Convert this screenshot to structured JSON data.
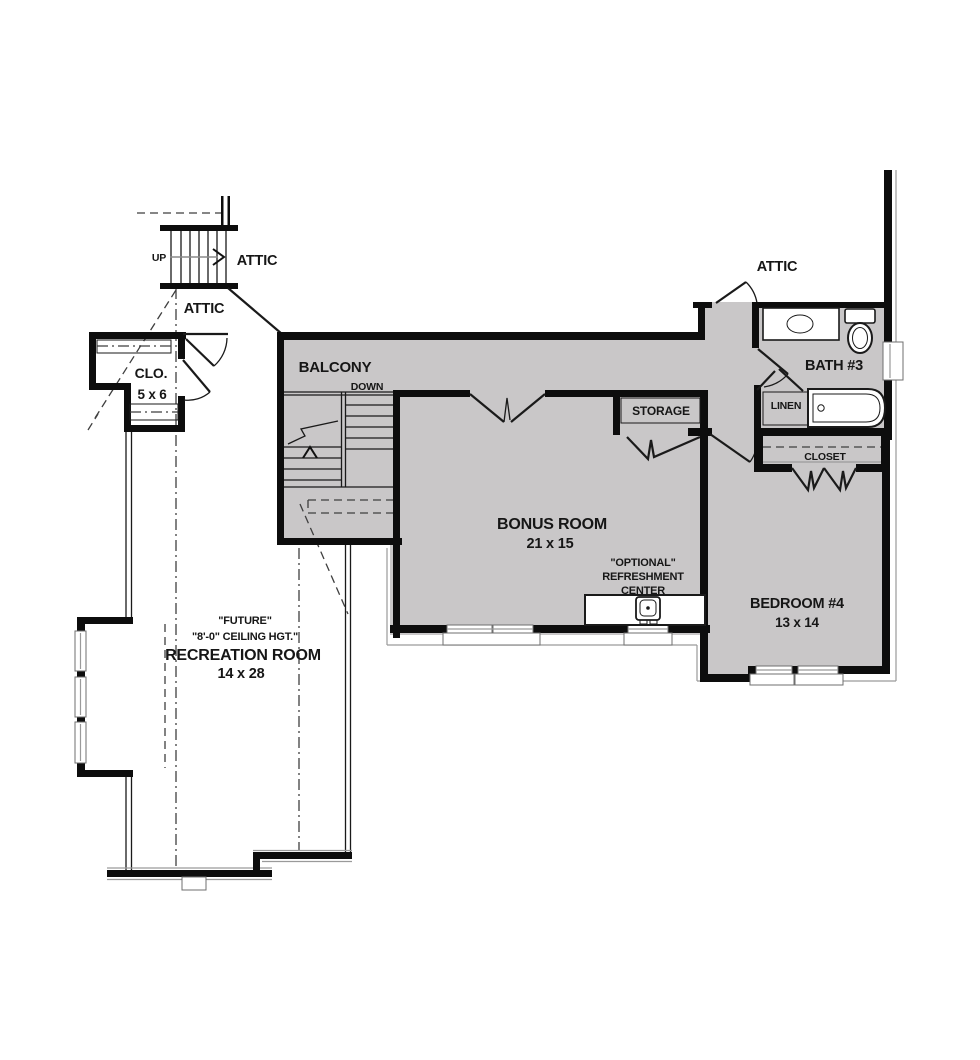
{
  "title": "Second Floor Plan",
  "colors": {
    "wall": "#0d0d0d",
    "room_fill": "#c9c7c8",
    "background": "#ffffff",
    "dashed_line": "#3f3f3f"
  },
  "rooms": {
    "attic_upper_left": {
      "label": "ATTIC"
    },
    "attic_lower_left": {
      "label": "ATTIC"
    },
    "attic_right": {
      "label": "ATTIC"
    },
    "stairs": {
      "up": "UP",
      "down": "DOWN"
    },
    "clo": {
      "label": "CLO.",
      "dimensions": "5 x 6"
    },
    "balcony": {
      "label": "BALCONY"
    },
    "bonus": {
      "label": "BONUS ROOM",
      "dimensions": "21 x 15"
    },
    "storage": {
      "label": "STORAGE"
    },
    "bath": {
      "label": "BATH #3"
    },
    "linen": {
      "label": "LINEN"
    },
    "closet": {
      "label": "CLOSET"
    },
    "bedroom": {
      "label": "BEDROOM #4",
      "dimensions": "13 x 14"
    },
    "refreshment": {
      "line1": "\"OPTIONAL\"",
      "line2": "REFRESHMENT",
      "line3": "CENTER"
    },
    "recreation": {
      "line1": "\"FUTURE\"",
      "line2": "\"8'-0\" CEILING HGT.\"",
      "line3": "RECREATION ROOM",
      "dimensions": "14 x 28"
    }
  }
}
